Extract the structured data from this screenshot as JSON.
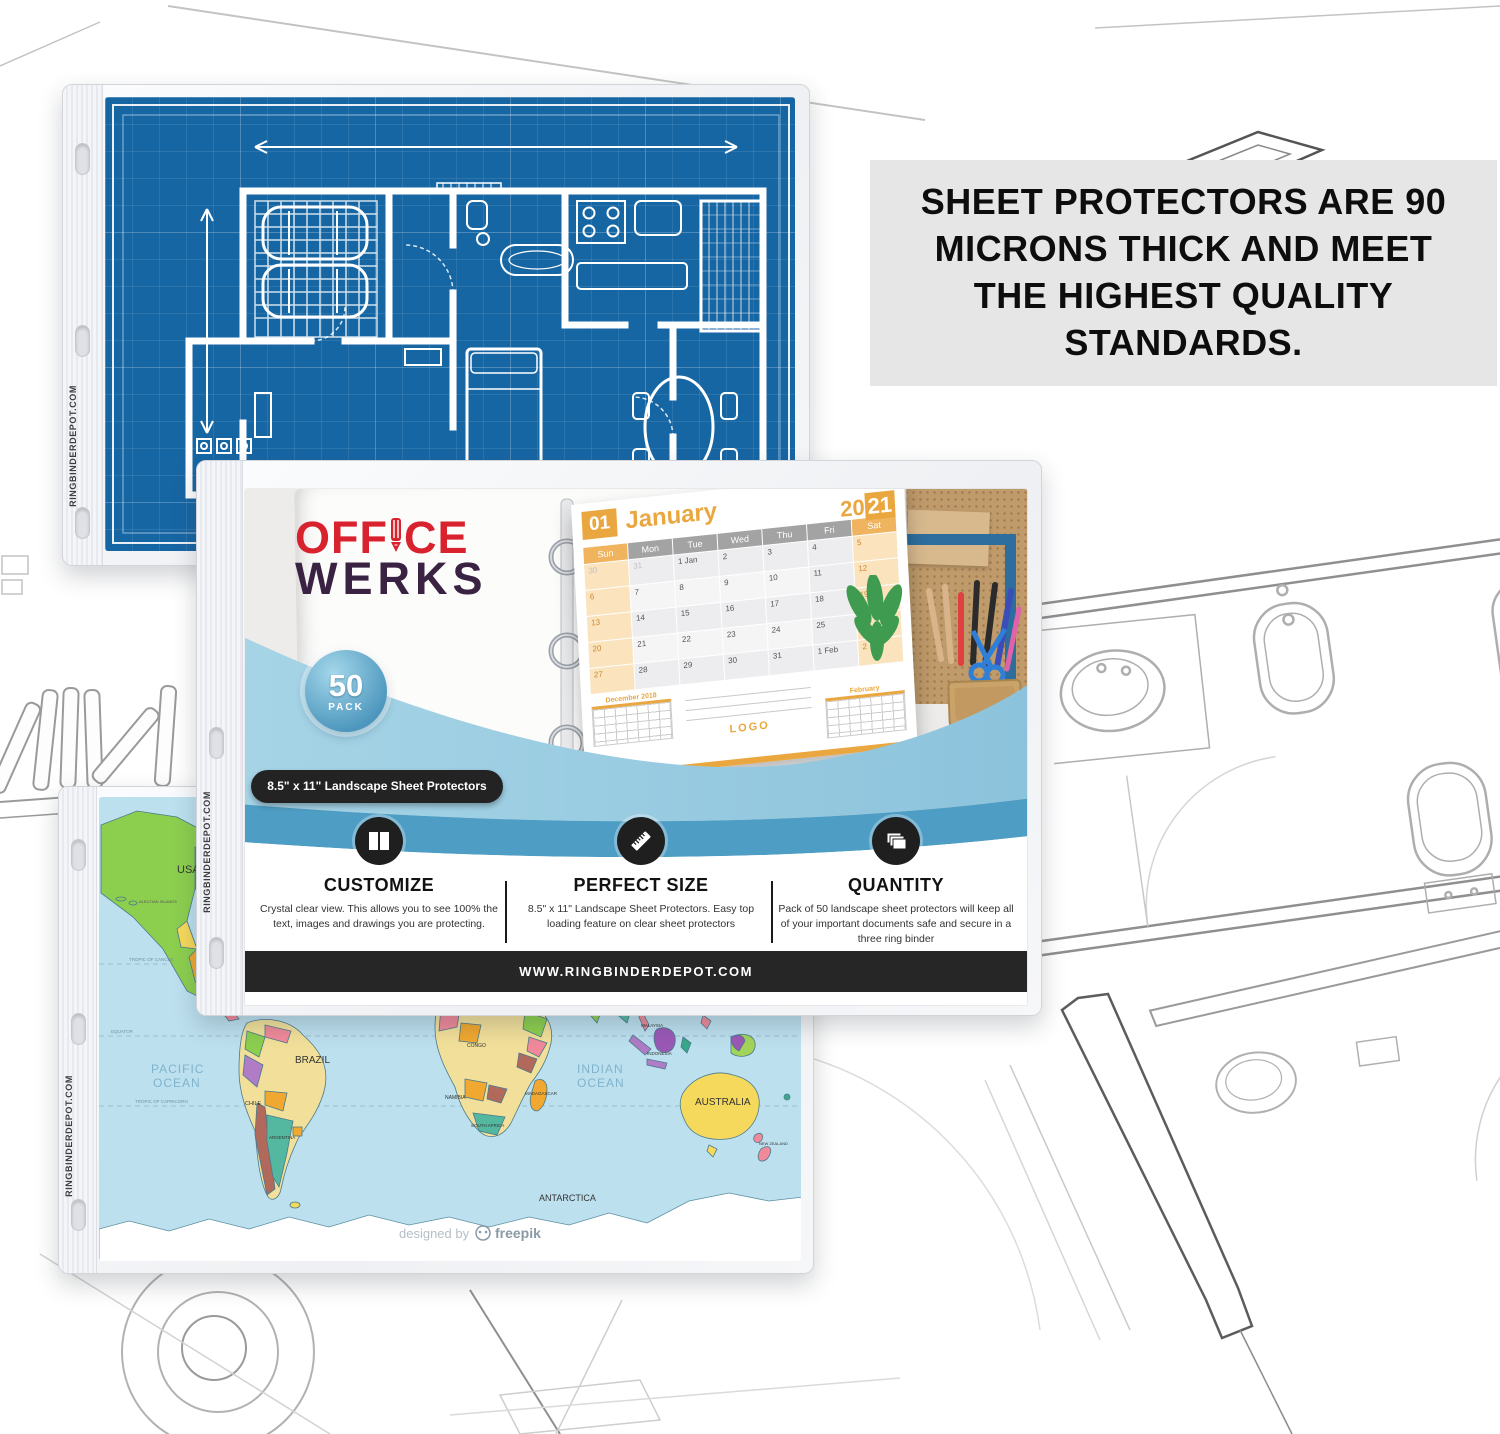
{
  "info_box": {
    "text": "SHEET PROTECTORS ARE 90 MICRONS THICK AND MEET THE HIGHEST QUALITY STANDARDS."
  },
  "edge_text": "RINGBINDERDEPOT.COM",
  "brand": {
    "word1_a": "OFF",
    "word1_b": "CE",
    "word2": "WERKS"
  },
  "badge": {
    "number": "50",
    "label": "PACK"
  },
  "size_pill": "8.5\" x 11\" Landscape Sheet Protectors",
  "features": [
    {
      "icon": "panels-icon",
      "title": "CUSTOMIZE",
      "desc": "Crystal clear view. This allows you to see 100% the text, images and drawings you are protecting."
    },
    {
      "icon": "ruler-icon",
      "title": "PERFECT SIZE",
      "desc": "8.5\" x 11\" Landscape Sheet Protectors. Easy top loading feature on clear sheet protectors"
    },
    {
      "icon": "stack-icon",
      "title": "QUANTITY",
      "desc": "Pack of 50 landscape sheet protectors will keep all of your important documents safe and secure in a three ring binder"
    }
  ],
  "website_bar": "WWW.RINGBINDERDEPOT.COM",
  "calendar": {
    "month_num": "01",
    "month": "January",
    "year_left": "20",
    "year_right": "21",
    "day_headers": [
      "Sun",
      "Mon",
      "Tue",
      "Wed",
      "Thu",
      "Fri",
      "Sat"
    ],
    "cells": [
      "30",
      "31",
      "1 Jan",
      "2",
      "3",
      "4",
      "5",
      "6",
      "7",
      "8",
      "9",
      "10",
      "11",
      "12",
      "13",
      "14",
      "15",
      "16",
      "17",
      "18",
      "19",
      "20",
      "21",
      "22",
      "23",
      "24",
      "25",
      "26",
      "27",
      "28",
      "29",
      "30",
      "31",
      "1 Feb",
      "2"
    ],
    "mini_left": "December 2018",
    "mini_right": "February",
    "logo": "LOGO"
  },
  "map": {
    "labels": {
      "ocean_partial": "OCEAN",
      "pacific_1": "PACIFIC",
      "pacific_2": "OCEAN",
      "indian_1": "INDIAN",
      "indian_2": "OCEAN",
      "equator": "EQUATOR",
      "tropic_cancer": "TROPIC OF CANCER",
      "tropic_capricorn": "TROPIC OF CAPRICORN",
      "usa": "USA",
      "aleutian": "ALEUTIAN ISLANDS",
      "brazil": "BRAZIL",
      "chile": "CHILE",
      "argentina": "ARGENTINA",
      "congo": "CONGO",
      "namibia": "NAMIBIA",
      "south_africa": "SOUTH AFRICA",
      "madagascar": "MADAGASCAR",
      "malaysia": "MALAYSIA",
      "indonesia": "INDONESIA",
      "philippines": "PHILIPPINES",
      "australia": "AUSTRALIA",
      "new_zealand": "NEW ZEALAND",
      "antarctica": "ANTARCTICA",
      "credit": "designed by",
      "credit_brand": "freepik"
    }
  },
  "colors": {
    "blueprint_blue": "#1766A4",
    "brand_red": "#D8232E",
    "brand_dark": "#3A2342",
    "accent_orange": "#EAA73F",
    "wave_light": "#A6D4E6",
    "wave_deep": "#4E9DC4",
    "info_box_bg": "#E6E6E6",
    "ocean": "#BDE0EF"
  }
}
